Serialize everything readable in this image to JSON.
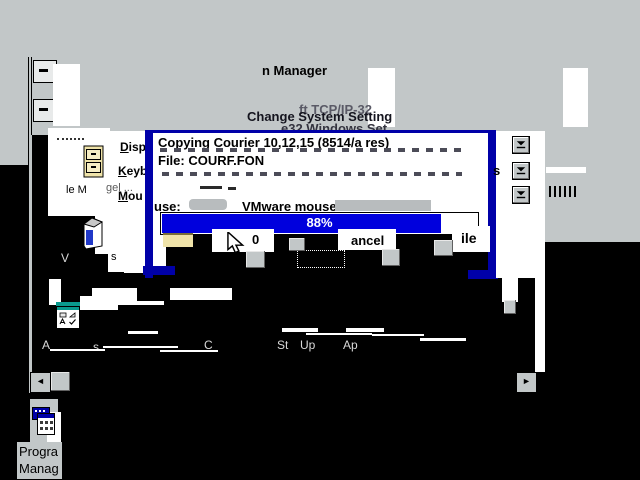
{
  "colors": {
    "desktop_gray": "#c2c7c8",
    "dialog_border_navy": "#0000a8",
    "progress_blue": "#0000dd",
    "group_icon_teal": "#0a9a8e",
    "folder_cream": "#efe3a9"
  },
  "titlebar": {
    "program_manager_title_fragment": "n Manager"
  },
  "ghost": {
    "tcpip_fragment": "ft TCP/IP-32",
    "change_system_settings": "Change System Setting",
    "windows_setup_fragment": "e32 Windows Set"
  },
  "copy_dialog": {
    "copying_line": "Copying Courier 10,12,15 (8514/a res)",
    "file_line": "File: COURF.FON",
    "progress_percent": 88,
    "progress_label": "88%"
  },
  "settings": {
    "display": {
      "first": "D",
      "rest": "isp"
    },
    "keyboard": {
      "first": "K",
      "rest": "eyb"
    },
    "mouse": {
      "first": "M",
      "rest": "ou"
    },
    "mouse_label_fragment": "use:",
    "mouse_value": "VMware mouse",
    "fragment_s": "s",
    "fragment_gel": "gel ...",
    "ok_fragment": "0",
    "cancel_fragment": "ancel",
    "file_fragment": "ile"
  },
  "icons_labels": {
    "file_manager_fragment": "le M",
    "tools_fragment_v": "V",
    "tools_fragment_s": "s"
  },
  "groups": {
    "accessories_fragment_a": "A",
    "accessories_fragment_s": "s",
    "games_fragment": "C",
    "startup_fragment_st": "St",
    "startup_fragment_up": "Up",
    "applications_fragment": "Ap"
  },
  "minimized_program_manager": {
    "label_line1": "Progra",
    "label_line2": "Manag"
  }
}
